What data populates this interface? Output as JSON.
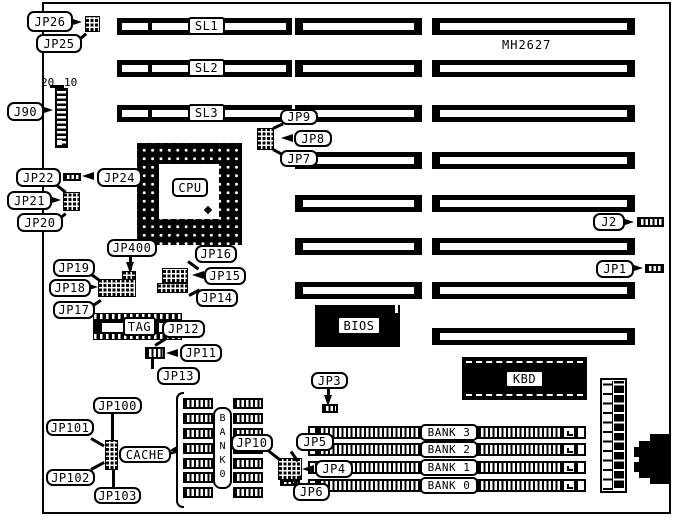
{
  "part_number": "MH2627",
  "chips": {
    "cpu": "CPU",
    "bios": "BIOS",
    "kbd": "KBD",
    "tag": "TAG",
    "cache_bank": "BANK0"
  },
  "slots": {
    "sl1": "SL1",
    "sl2": "SL2",
    "sl3": "SL3"
  },
  "memory_banks": [
    "BANK 3",
    "BANK 2",
    "BANK 1",
    "BANK 0"
  ],
  "j90_pin_labels": {
    "pin20": "20",
    "pin10": "10"
  },
  "callouts": {
    "jp26": "JP26",
    "jp25": "JP25",
    "j90": "J90",
    "jp22": "JP22",
    "jp24": "JP24",
    "jp21": "JP21",
    "jp20": "JP20",
    "jp19": "JP19",
    "jp18": "JP18",
    "jp17": "JP17",
    "jp400": "JP400",
    "jp16": "JP16",
    "jp15": "JP15",
    "jp14": "JP14",
    "jp12": "JP12",
    "jp11": "JP11",
    "jp13": "JP13",
    "jp9": "JP9",
    "jp8": "JP8",
    "jp7": "JP7",
    "j2": "J2",
    "jp1": "JP1",
    "jp3": "JP3",
    "jp100": "JP100",
    "jp101": "JP101",
    "jp102": "JP102",
    "jp103": "JP103",
    "cache": "CACHE",
    "jp10": "JP10",
    "jp5": "JP5",
    "jp4": "JP4",
    "jp6": "JP6"
  }
}
